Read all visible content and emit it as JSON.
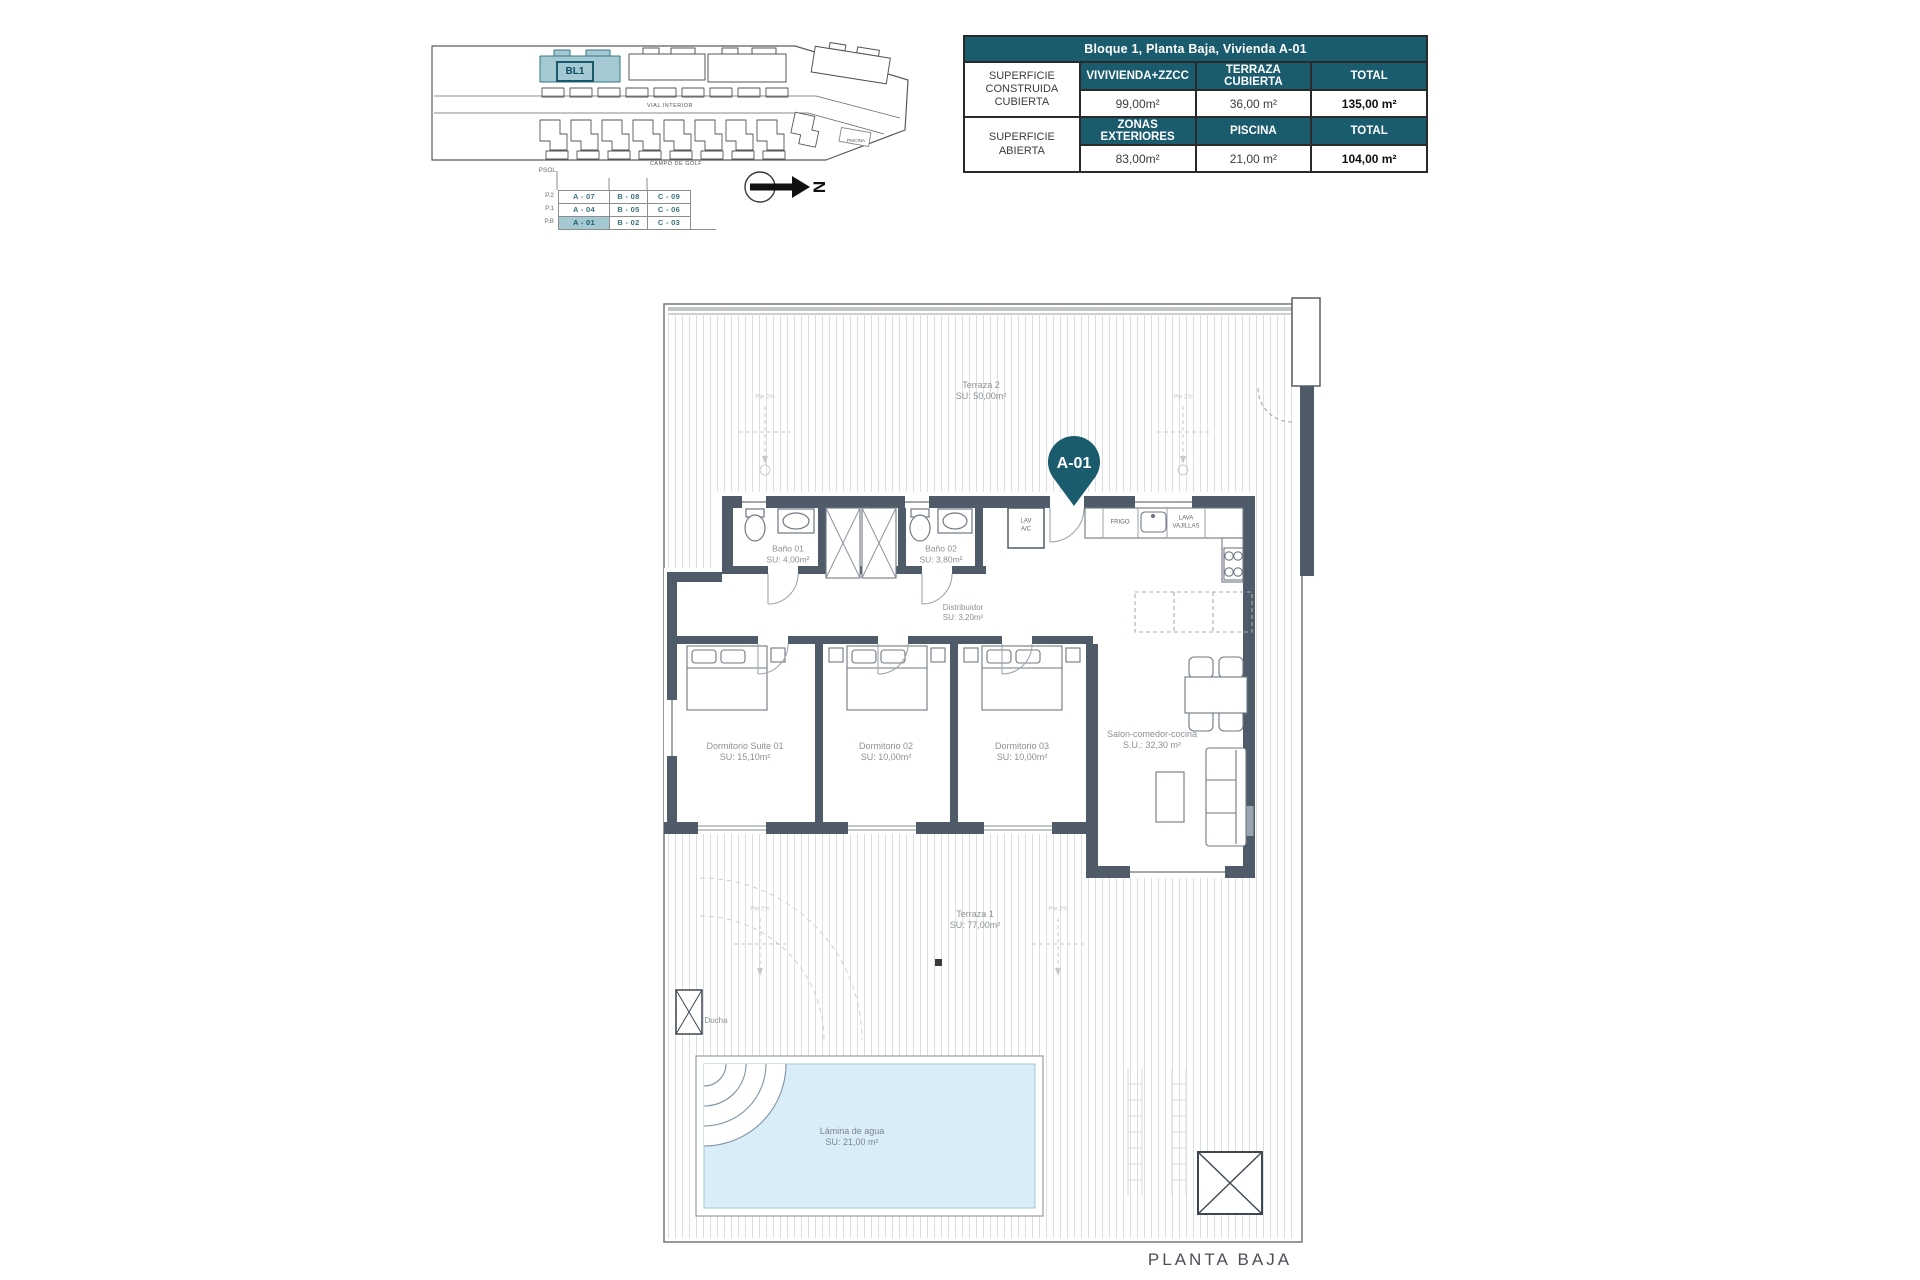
{
  "page": {
    "plan_title": "PLANTA BAJA"
  },
  "summary_table": {
    "title": "Bloque 1, Planta Baja, Vivienda A-01",
    "row1": {
      "label": "SUPERFICIE CONSTRUIDA CUBIERTA",
      "col1": "VIVIVIENDA+ZZCC",
      "col2": "TERRAZA CUBIERTA",
      "col3": "TOTAL",
      "val1": "99,00m²",
      "val2": "36,00 m²",
      "val3": "135,00 m²"
    },
    "row2": {
      "label": "SUPERFICIE ABIERTA",
      "col1": "ZONAS EXTERIORES",
      "col2": "PISCINA",
      "col3": "TOTAL",
      "val1": "83,00m²",
      "val2": "21,00 m²",
      "val3": "104,00 m²"
    }
  },
  "site_plan": {
    "block_label": "BL1",
    "street": "VIAL INTERIOR",
    "golf": "CAMPO DE GOLF",
    "pool": "PISCINA",
    "north": "N"
  },
  "levels": {
    "axis": "PSOL",
    "rows": [
      {
        "level": "P.2",
        "units": [
          "A - 07",
          "B - 08",
          "C - 09"
        ]
      },
      {
        "level": "P.1",
        "units": [
          "A - 04",
          "B - 05",
          "C - 06"
        ]
      },
      {
        "level": "P.B",
        "units": [
          "A - 01",
          "B - 02",
          "C - 03"
        ]
      }
    ],
    "highlighted_unit": "A - 01"
  },
  "plan": {
    "unit_pin": "A-01",
    "terraza2": {
      "name": "Terraza 2",
      "area": "SU: 50,00m²"
    },
    "terraza1": {
      "name": "Terraza 1",
      "area": "SU: 77,00m²"
    },
    "bano1": {
      "name": "Baño 01",
      "area": "SU: 4,00m²"
    },
    "bano2": {
      "name": "Baño 02",
      "area": "SU: 3,80m²"
    },
    "distribuidor": {
      "name": "Distribuidor",
      "area": "SU: 3,20m²"
    },
    "suite": {
      "name": "Dormitorio Suite 01",
      "area": "SU: 15,10m²"
    },
    "dorm2": {
      "name": "Dormitorio 02",
      "area": "SU: 10,00m²"
    },
    "dorm3": {
      "name": "Dormitorio 03",
      "area": "SU: 10,00m²"
    },
    "salon": {
      "name": "Salon-comedor-cocina",
      "area": "S.U.: 32,30 m²"
    },
    "pool": {
      "name": "Lámina de agua",
      "area": "SU: 21,00 m²"
    },
    "ducha": "Ducha",
    "kitchen": {
      "fridge": "FRIGO",
      "dishwasher1": "LAVA",
      "dishwasher2": "VAJILLAS",
      "lav": "LAV",
      "ac": "A/C"
    },
    "slope": "Pte 2%"
  },
  "colors": {
    "teal": "#1a5b6e",
    "teal_light": "#a4c9d3",
    "wall": "#4f5b69",
    "water": "#d8edf8"
  }
}
